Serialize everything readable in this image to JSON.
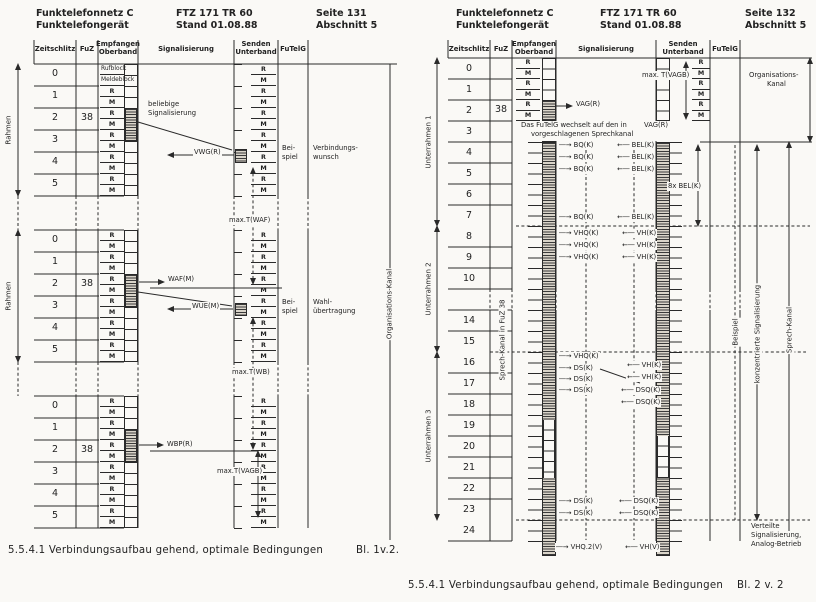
{
  "colors": {
    "ink": "#2a2a2a",
    "paper": "#faf9f6"
  },
  "left": {
    "header": {
      "org1": "Funktelefonnetz C",
      "org2": "Funktelefongerät",
      "doc1": "FTZ 171 TR 60",
      "doc2": "Stand 01.08.88",
      "page1": "Seite 131",
      "page2": "Abschnitt 5"
    },
    "columns": [
      [
        "Zeitschlitz"
      ],
      [
        "FuZ"
      ],
      [
        "Empfangen",
        "Oberband"
      ],
      [
        "Signalisierung"
      ],
      [
        "Senden",
        "Unterband"
      ],
      [
        "FuTelG"
      ]
    ],
    "frame_label": "Rahmen",
    "org_label": "Organisations-Kanal",
    "slot_numbers": [
      "0",
      "1",
      "2",
      "3",
      "4",
      "5"
    ],
    "fuz": "38",
    "row0": [
      "Rufblock",
      "Meldeblock"
    ],
    "rm": [
      "R",
      "M"
    ],
    "example": [
      "Bei-",
      "spiel"
    ],
    "sig_labels": [
      {
        "t": "beliebige",
        "x": 147,
        "y": 100
      },
      {
        "t": "Signalisierung",
        "x": 147,
        "y": 109
      },
      {
        "t": "VWG(R)",
        "x": 193,
        "y": 148
      },
      {
        "t": "max.T(WAF)",
        "x": 228,
        "y": 216
      },
      {
        "t": "WAF(M)",
        "x": 167,
        "y": 275
      },
      {
        "t": "WUE(M)",
        "x": 191,
        "y": 302
      },
      {
        "t": "max.T(WB)",
        "x": 231,
        "y": 368
      },
      {
        "t": "WBP(R)",
        "x": 166,
        "y": 440
      },
      {
        "t": "max.T(VAGB)",
        "x": 216,
        "y": 467
      }
    ],
    "annotations": [
      {
        "l1": "Verbindungs-",
        "l2": "wunsch",
        "x": 312,
        "y": 144
      },
      {
        "l1": "Wahl-",
        "l2": "übertragung",
        "x": 312,
        "y": 298
      }
    ],
    "caption": "5.5.4.1 Verbindungsaufbau gehend, optimale Bedingungen",
    "sheet": "Bl. 1v.2."
  },
  "right": {
    "header": {
      "org1": "Funktelefonnetz C",
      "org2": "Funktelefongerät",
      "doc1": "FTZ 171 TR 60",
      "doc2": "Stand 01.08.88",
      "page1": "Seite 132",
      "page2": "Abschnitt 5"
    },
    "columns": [
      [
        "Zeitschlitz"
      ],
      [
        "FuZ"
      ],
      [
        "Empfangen",
        "Oberband"
      ],
      [
        "Signalisierung"
      ],
      [
        "Senden",
        "Unterband"
      ],
      [
        "FuTelG"
      ]
    ],
    "subframe_labels": [
      "Unterrahmen 1",
      "Unterrahmen 2",
      "Unterrahmen 3"
    ],
    "row_numbers": [
      "0",
      "1",
      "2",
      "3",
      "4",
      "5",
      "6",
      "7",
      "8",
      "9",
      "10",
      "14",
      "15",
      "16",
      "17",
      "18",
      "19",
      "20",
      "21",
      "22",
      "23",
      "24"
    ],
    "fuz": "38",
    "rm": [
      "R",
      "M"
    ],
    "speech_label": "Sprech-Kanal in FuZ 38",
    "note": {
      "l1": "Das FuTelG wechselt auf den in",
      "l2": "vorgeschlagenen Sprechkanal",
      "arrow_label": "VAG(R)"
    },
    "sig_labels": [
      {
        "t": "VAG(R)",
        "x": 575,
        "y": 100
      },
      {
        "t": "max. T(VAGB)",
        "x": 641,
        "y": 71
      },
      {
        "t": "―→ BQ(K)",
        "x": 558,
        "y": 141
      },
      {
        "t": "―→ BQ(K)",
        "x": 558,
        "y": 153
      },
      {
        "t": "―→ BQ(K)",
        "x": 558,
        "y": 165
      },
      {
        "t": "←― BEL(K)",
        "x": 616,
        "y": 141
      },
      {
        "t": "←― BEL(K)",
        "x": 616,
        "y": 153
      },
      {
        "t": "←― BEL(K)",
        "x": 616,
        "y": 165
      },
      {
        "t": "8x BEL(K)",
        "x": 667,
        "y": 182
      },
      {
        "t": "―→ BQ(K)",
        "x": 558,
        "y": 213
      },
      {
        "t": "←― BEL(K)",
        "x": 616,
        "y": 213
      },
      {
        "t": "―→ VHQ(K)",
        "x": 558,
        "y": 229
      },
      {
        "t": "―→ VHQ(K)",
        "x": 558,
        "y": 241
      },
      {
        "t": "―→ VHQ(K)",
        "x": 558,
        "y": 253
      },
      {
        "t": "←― VH(K)",
        "x": 621,
        "y": 229
      },
      {
        "t": "←― VH(K)",
        "x": 621,
        "y": 241
      },
      {
        "t": "←― VH(K)",
        "x": 621,
        "y": 253
      },
      {
        "t": "―→ VHQ(K)",
        "x": 558,
        "y": 352
      },
      {
        "t": "―→ DS(K)",
        "x": 558,
        "y": 364
      },
      {
        "t": "―→ DS(K)",
        "x": 558,
        "y": 375
      },
      {
        "t": "―→ DS(K)",
        "x": 558,
        "y": 386
      },
      {
        "t": "←― VH(K)",
        "x": 626,
        "y": 361
      },
      {
        "t": "←― VH(K)",
        "x": 626,
        "y": 373
      },
      {
        "t": "←― DSQ(K)",
        "x": 620,
        "y": 386
      },
      {
        "t": "←― DSQ(K)",
        "x": 620,
        "y": 398
      },
      {
        "t": "―→ DS(K)",
        "x": 558,
        "y": 497
      },
      {
        "t": "―→ DS(K)",
        "x": 558,
        "y": 509
      },
      {
        "t": "←― DSQ(K)",
        "x": 618,
        "y": 497
      },
      {
        "t": "←― DSQ(K)",
        "x": 618,
        "y": 509
      },
      {
        "t": "―→ VHQ.2(V)",
        "x": 555,
        "y": 543
      },
      {
        "t": "←― VH(V)",
        "x": 624,
        "y": 543
      },
      {
        "t": "VAG(R)",
        "x": 643,
        "y": 121
      }
    ],
    "side": {
      "org1": "Organisations-",
      "org2": "Kanal",
      "beispiel": "Beispiel",
      "konz": "konzentrierte Signalisierung",
      "sprech": "Sprech-Kanal",
      "vert1": "Verteilte",
      "vert2": "Signalisierung,",
      "vert3": "Analog-Betrieb"
    },
    "caption": "5.5.4.1 Verbindungsaufbau gehend, optimale Bedingungen",
    "sheet": "Bl. 2 v. 2"
  }
}
